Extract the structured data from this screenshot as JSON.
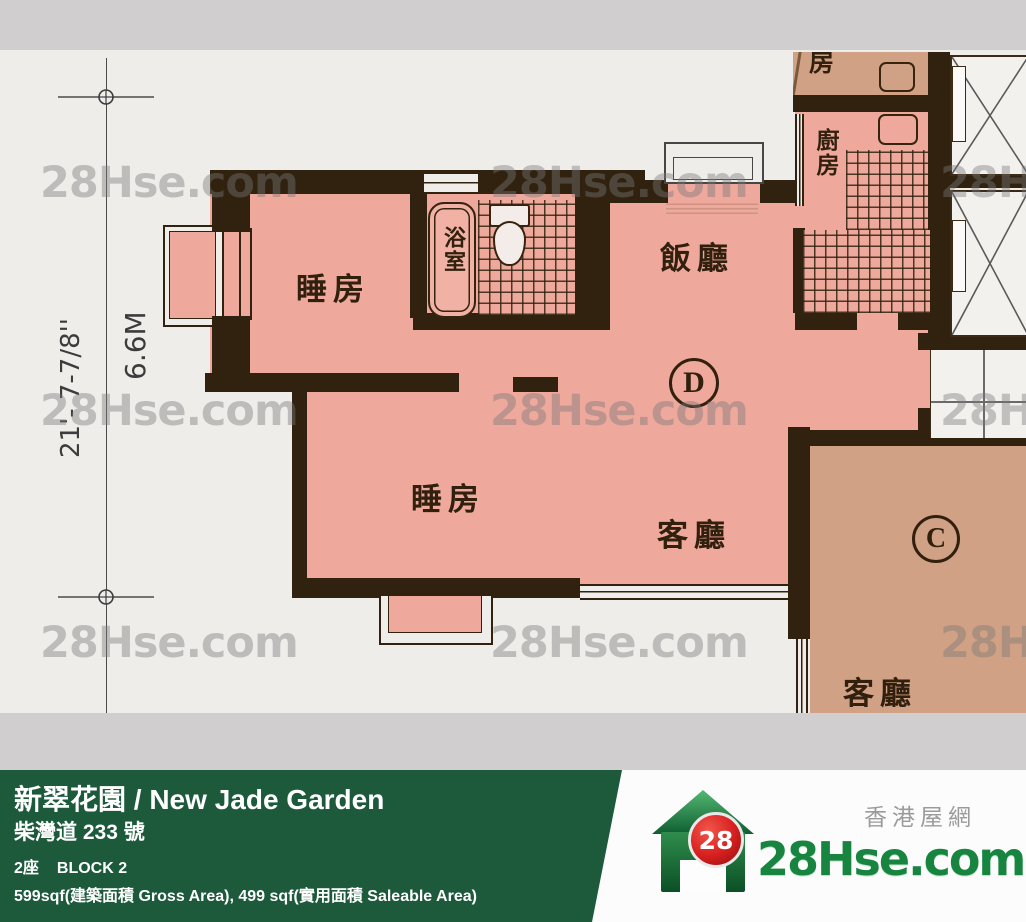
{
  "plan": {
    "watermark": "28Hse.com",
    "dimension_imperial": "21'- 7-7/8''",
    "dimension_metric": "6.6M",
    "unit_d": "D",
    "unit_c": "C",
    "labels": {
      "bedroom1": "睡房",
      "bedroom2": "睡房",
      "bathroom": "浴室",
      "kitchen": "廚房",
      "dining": "飯廳",
      "living_d": "客廳",
      "living_c": "客廳",
      "partial_room": "房"
    }
  },
  "footer": {
    "title": "新翠花園 / New Jade Garden",
    "address": "柴灣道 233 號",
    "block_cn": "2座",
    "block_en": "BLOCK 2",
    "area": "599sqf(建築面積 Gross Area), 499 sqf(實用面積 Saleable Area)"
  },
  "logo": {
    "badge": "28",
    "site": "28Hse.com",
    "tagline": "香港屋網"
  },
  "colors": {
    "unit_d_fill": "#eea89c",
    "unit_c_fill": "#d0a184",
    "wall": "#30220f",
    "banner_green": "#1d5a3c",
    "logo_green": "#178540",
    "logo_red": "#d61f1f"
  }
}
